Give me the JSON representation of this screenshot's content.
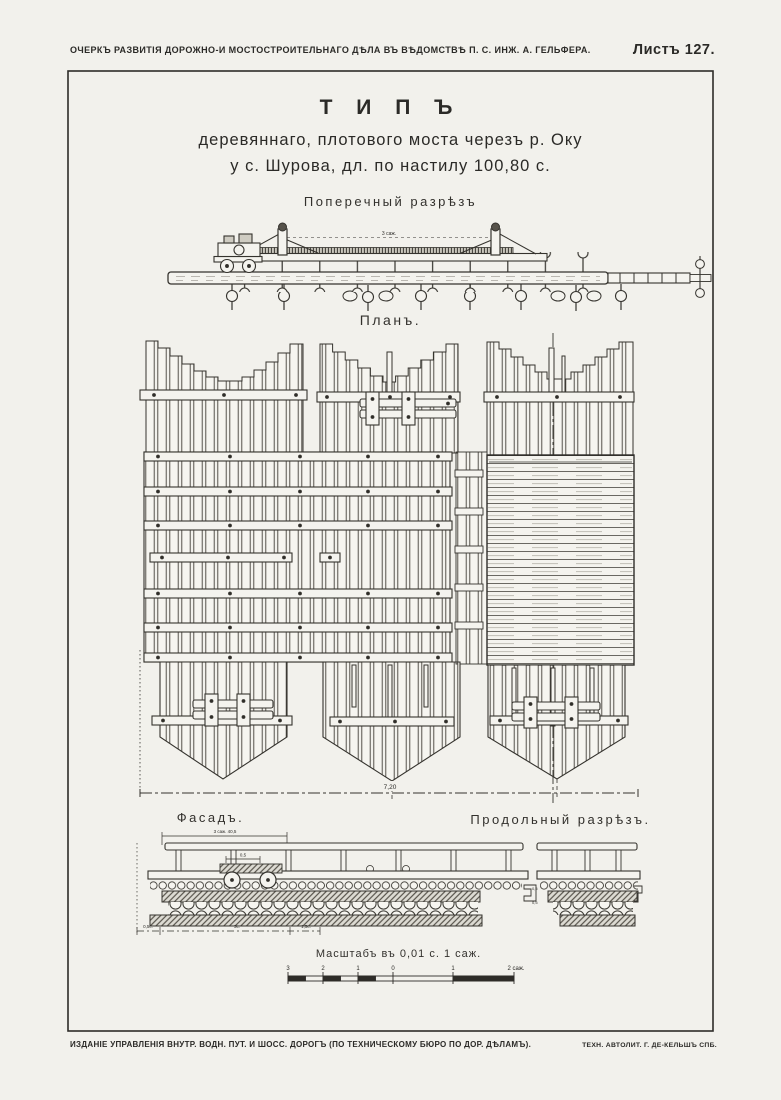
{
  "colors": {
    "paper": "#f2f1ec",
    "ink": "#2b2a27",
    "hatch_bg": "#dddbd3"
  },
  "header": {
    "left": "ОЧЕРКЪ РАЗВИТІЯ ДОРОЖНО-И МОСТОСТРОИТЕЛЬНАГО ДѢЛА ВЪ ВѢДОМСТВѢ П. С. ИНЖ. А. ГЕЛЬФЕРА.",
    "sheet": "Листъ 127."
  },
  "title": {
    "line1": "Т И П Ъ",
    "line2": "деревяннаго, плотового моста черезъ р. Оку",
    "line3": "у с. Шурова, дл. по настилу 100,80 с."
  },
  "labels": {
    "cross_section": "Поперечный разрѣзъ",
    "plan": "Планъ.",
    "facade": "Фасадъ.",
    "longitudinal": "Продольный разрѣзъ.",
    "scale_caption": "Масштабъ въ 0,01 с. 1 саж."
  },
  "dims": {
    "span": "3 саж.",
    "plan_width": "7,20",
    "bracket": "3 саж. 40,5",
    "cart": "0,5",
    "facade_left": "0,5с.",
    "facade_mid": "3с.",
    "facade_right": "1,5с.",
    "j1": "0,5",
    "j2": "0,5"
  },
  "scale_ticks": [
    "3",
    "2",
    "1",
    "0",
    "1",
    "2 саж."
  ],
  "footer": {
    "left": "ИЗДАНІЕ УПРАВЛЕНІЯ ВНУТР. ВОДН. ПУТ. И ШОСС. ДОРОГЪ (ПО ТЕХНИЧЕСКОМУ БЮРО ПО ДОР. ДѢЛАМЪ).",
    "right": "ТЕХН. АВТОЛИТ. Г. ДЕ-КЕЛЬШЪ СПБ."
  }
}
